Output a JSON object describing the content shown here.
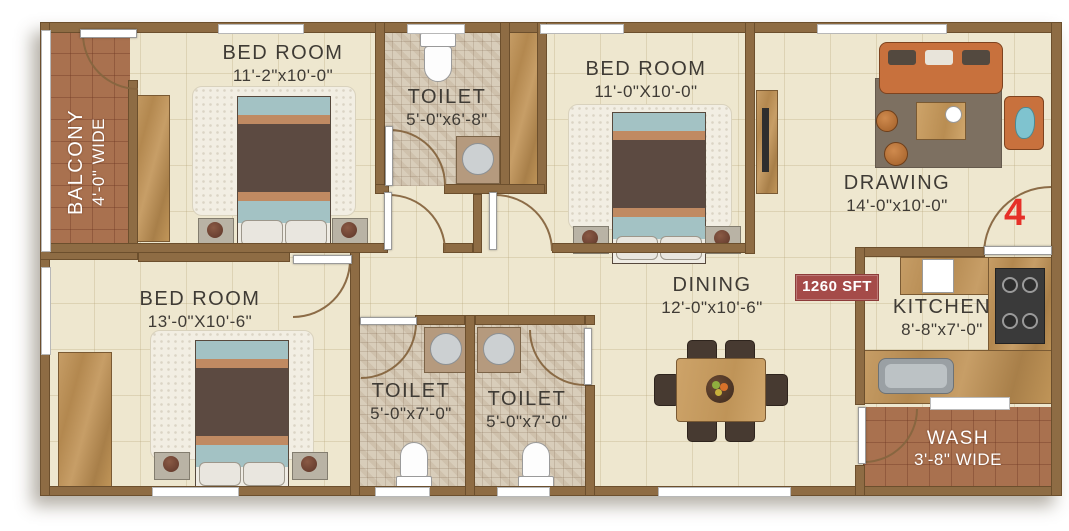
{
  "plan": {
    "unit_number": "4",
    "area_badge": "1260 SFT",
    "rooms": {
      "balcony": {
        "name": "BALCONY",
        "dims": "4'-0\" WIDE"
      },
      "bedroom_top_left": {
        "name": "BED ROOM",
        "dims": "11'-2\"x10'-0\""
      },
      "toilet_top": {
        "name": "TOILET",
        "dims": "5'-0\"x6'-8\""
      },
      "bedroom_top_mid": {
        "name": "BED ROOM",
        "dims": "11'-0\"X10'-0\""
      },
      "drawing": {
        "name": "DRAWING",
        "dims": "14'-0\"x10'-0\""
      },
      "bedroom_bottom_left": {
        "name": "BED ROOM",
        "dims": "13'-0\"X10'-6\""
      },
      "toilet_bottom_left": {
        "name": "TOILET",
        "dims": "5'-0\"x7'-0\""
      },
      "toilet_bottom_right": {
        "name": "TOILET",
        "dims": "5'-0\"x7'-0\""
      },
      "dining": {
        "name": "DINING",
        "dims": "12'-0\"x10'-6\""
      },
      "kitchen": {
        "name": "KITCHEN",
        "dims": "8'-8\"x7'-0\""
      },
      "wash": {
        "name": "WASH",
        "dims": "3'-8\" WIDE"
      }
    },
    "colors": {
      "wall": "#8e6c44",
      "floor": "#eee7cf",
      "brick_tile": "#a9714f",
      "mosaic_tile": "#d8cdba",
      "badge_red": "#a54b49",
      "unit_number_red": "#e63028"
    }
  }
}
